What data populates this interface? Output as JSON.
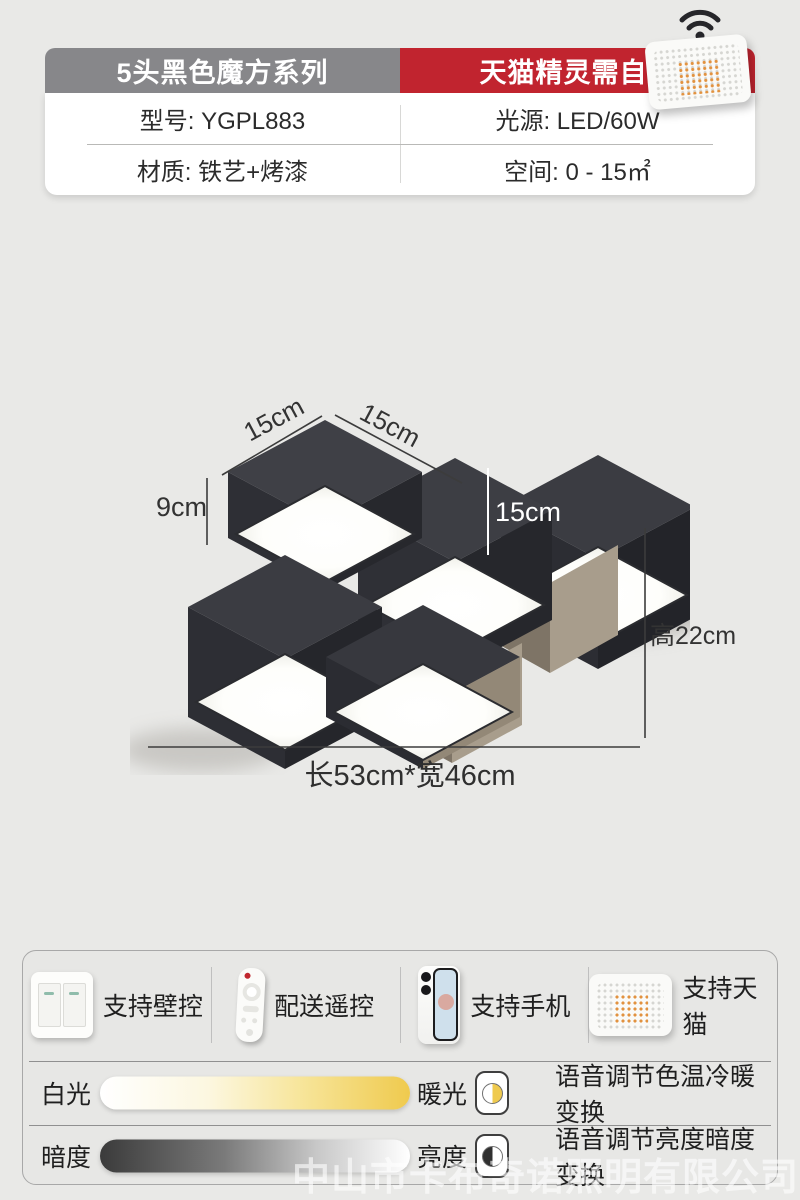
{
  "colors": {
    "accent_red": "#c1242f",
    "tab_gray": "#87878a",
    "warm_yellow": "#efca4e",
    "page_bg": "#e9e9e7"
  },
  "header": {
    "series_tab": "5头黑色魔方系列",
    "notice_tab": "天猫精灵需自购",
    "specs": {
      "model": "型号: YGPL883",
      "light_source": "光源: LED/60W",
      "material": "材质: 铁艺+烤漆",
      "space": "空间: 0 - 15㎡"
    }
  },
  "diagram": {
    "dim_top_left": "15cm",
    "dim_top_right": "15cm",
    "dim_side_height": "9cm",
    "dim_cube_face": "15cm",
    "dim_total_height": "高22cm",
    "dim_footprint": "长53cm*宽46cm"
  },
  "features": [
    {
      "label": "支持壁控",
      "icon": "wall-switch-icon"
    },
    {
      "label": "配送遥控",
      "icon": "remote-control-icon"
    },
    {
      "label": "支持手机",
      "icon": "smartphone-icon"
    },
    {
      "label": "支持天猫",
      "icon": "smart-speaker-icon"
    }
  ],
  "sliders": [
    {
      "left_label": "白光",
      "right_label": "暖光",
      "description": "语音调节色温冷暖变换"
    },
    {
      "left_label": "暗度",
      "right_label": "亮度",
      "description": "语音调节亮度暗度变换"
    }
  ],
  "watermark": "中山市卡布奇诺照明有限公司"
}
